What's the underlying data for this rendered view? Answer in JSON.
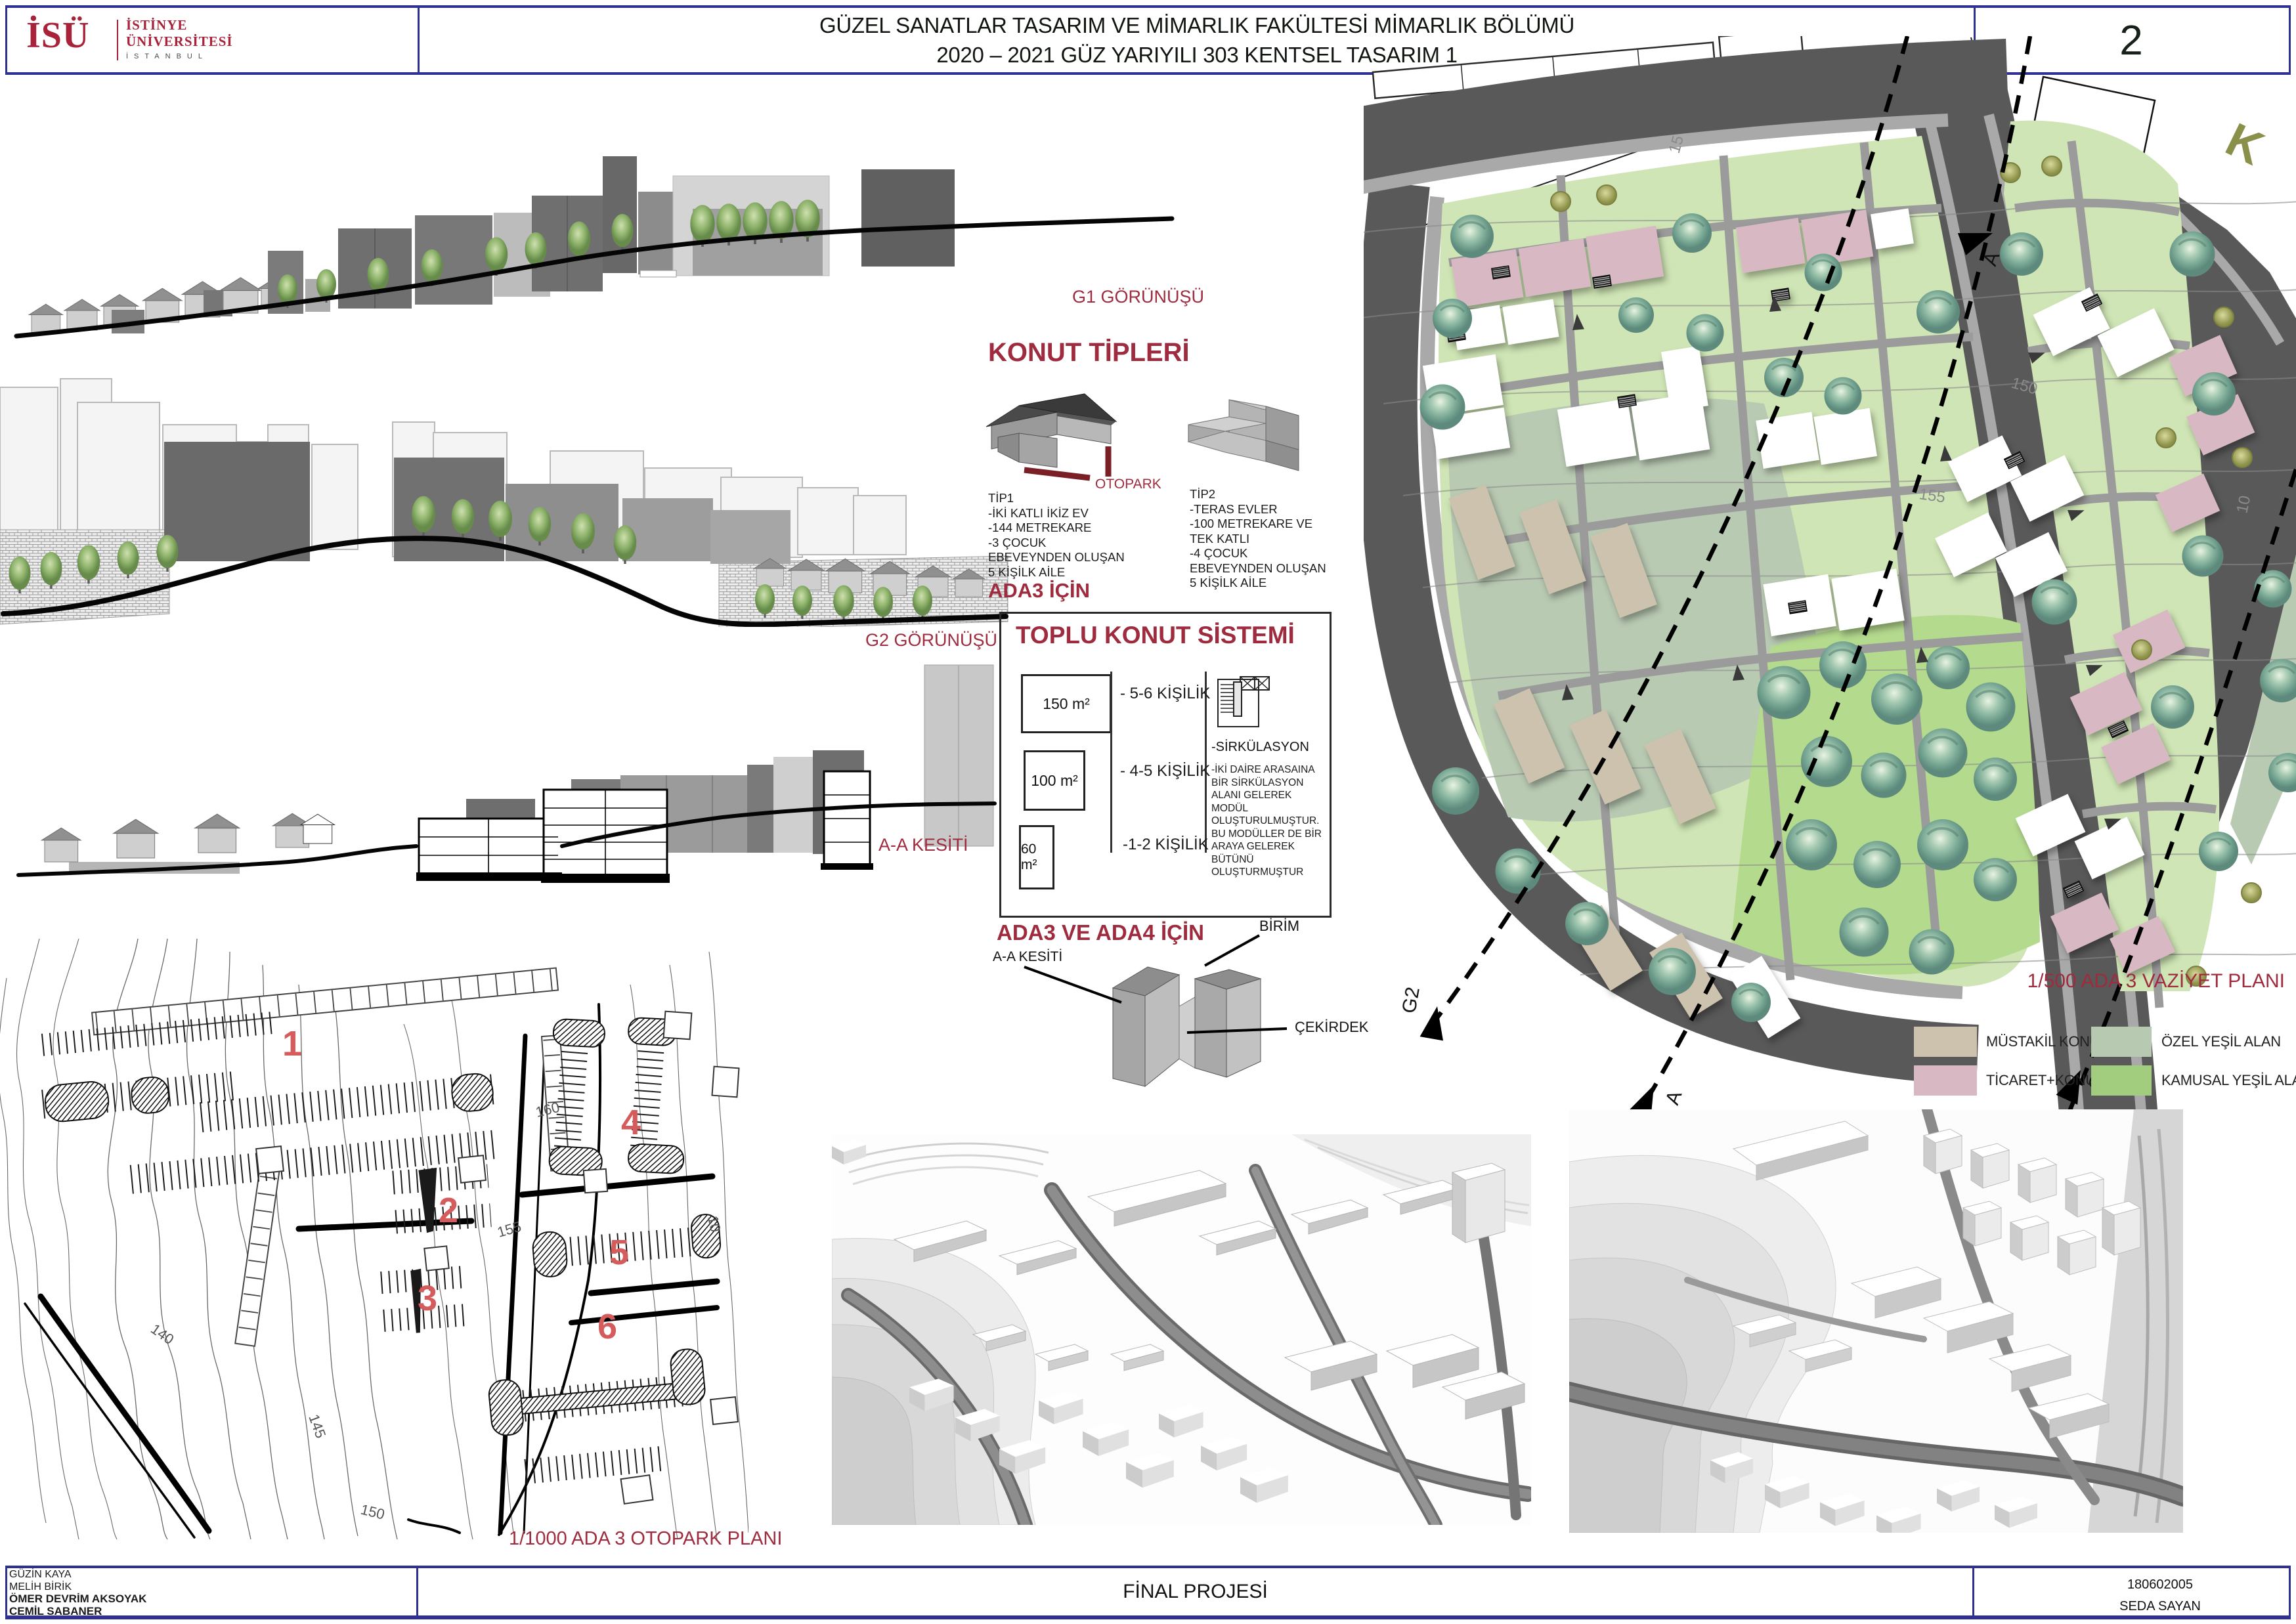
{
  "header": {
    "logo_abbr": "İSÜ",
    "logo_line1": "İSTİNYE",
    "logo_line2": "ÜNİVERSİTESİ",
    "logo_line3": "İSTANBUL",
    "title_line1": "GÜZEL SANATLAR TASARIM VE MİMARLIK FAKÜLTESİ MİMARLIK BÖLÜMÜ",
    "title_line2": "2020 – 2021 GÜZ YARIYILI 303 KENTSEL TASARIM 1",
    "page_number": "2"
  },
  "drawings": {
    "g1_label": "G1 GÖRÜNÜŞÜ",
    "g2_label": "G2 GÖRÜNÜŞÜ",
    "aa_label": "A-A KESİTİ"
  },
  "konut_tipleri": {
    "heading": "KONUT TİPLERİ",
    "otopark_label": "OTOPARK",
    "tip1_name": "TİP1",
    "tip1_line1": "-İKİ KATLI İKİZ EV",
    "tip1_line2": "-144 METREKARE",
    "tip1_line3": "-3 ÇOCUK",
    "tip1_line4": "EBEVEYNDEN OLUŞAN",
    "tip1_line5": "5 KİŞİLK AİLE",
    "tip1_for": "ADA3 İÇİN",
    "tip2_name": "TİP2",
    "tip2_line1": "-TERAS EVLER",
    "tip2_line2": "-100 METREKARE VE",
    "tip2_line3": "TEK KATLI",
    "tip2_line4": "-4 ÇOCUK",
    "tip2_line5": "EBEVEYNDEN OLUŞAN",
    "tip2_line6": "5 KİŞİLK AİLE"
  },
  "toplu_konut": {
    "heading": "TOPLU KONUT SİSTEMİ",
    "unit1_area": "150 m²",
    "unit1_capacity": "- 5-6 KİŞİLİK",
    "unit2_area": "100 m²",
    "unit2_capacity": "- 4-5 KİŞİLİK",
    "unit3_area": "60 m²",
    "unit3_capacity": "-1-2 KİŞİLİK",
    "sirkulasyon": "-SİRKÜLASYON",
    "description": "-İKİ DAİRE ARASAINA BİR SİRKÜLASYON ALANI GELEREK MODÜL OLUŞTURULMUŞTUR. BU MODÜLLER DE BİR ARAYA GELEREK BÜTÜNÜ OLUŞTURMUŞTUR",
    "for_label": "ADA3 VE ADA4 İÇİN",
    "section_label": "A-A KESİTİ",
    "birim_label": "BİRİM",
    "cekirdek_label": "ÇEKİRDEK"
  },
  "site_plan": {
    "title": "1/500 ADA 3 VAZİYET PLANI",
    "north_label": "K",
    "marker_a_top": "A",
    "marker_a_bottom": "A",
    "marker_g1": "G1",
    "marker_g2": "G2",
    "contour_15": "15",
    "contour_150": "150",
    "contour_155": "155",
    "contour_10": "10",
    "legend": [
      {
        "label": "MÜSTAKİL KONUT",
        "color": "#cdc2ad"
      },
      {
        "label": "ÖZEL YEŞİL ALAN",
        "color": "#b7c9b1"
      },
      {
        "label": "TİCARET+KONUT",
        "color": "#d8b9c3"
      },
      {
        "label": "KAMUSAL YEŞİL ALAN",
        "color": "#a3cd7e"
      }
    ]
  },
  "otopark_plan": {
    "title": "1/1000 ADA 3 OTOPARK PLANI",
    "numbers": [
      "1",
      "2",
      "3",
      "4",
      "5",
      "6"
    ],
    "contour_140": "140",
    "contour_145": "145",
    "contour_150": "150",
    "contour_155": "155",
    "contour_160": "160",
    "contour_10": "10"
  },
  "footer": {
    "name1": "GÜZİN KAYA",
    "name2": "MELİH BİRİK",
    "name3": "ÖMER DEVRİM AKSOYAK",
    "name4": "CEMİL SABANER",
    "project_label": "FİNAL PROJESİ",
    "student_id": "180602005",
    "student_name": "SEDA SAYAN"
  },
  "colors": {
    "border_navy": "#2e3192",
    "heading_red": "#9e2b3e",
    "logo_red": "#a8233a",
    "number_red": "#d45c5c",
    "road_dark": "#595959",
    "green_base": "#cfe5b5",
    "green_public": "#a3cd7e",
    "green_private": "#b7c9b1",
    "pink_commercial": "#d8b9c3",
    "tan_detached": "#cdc2ad"
  }
}
